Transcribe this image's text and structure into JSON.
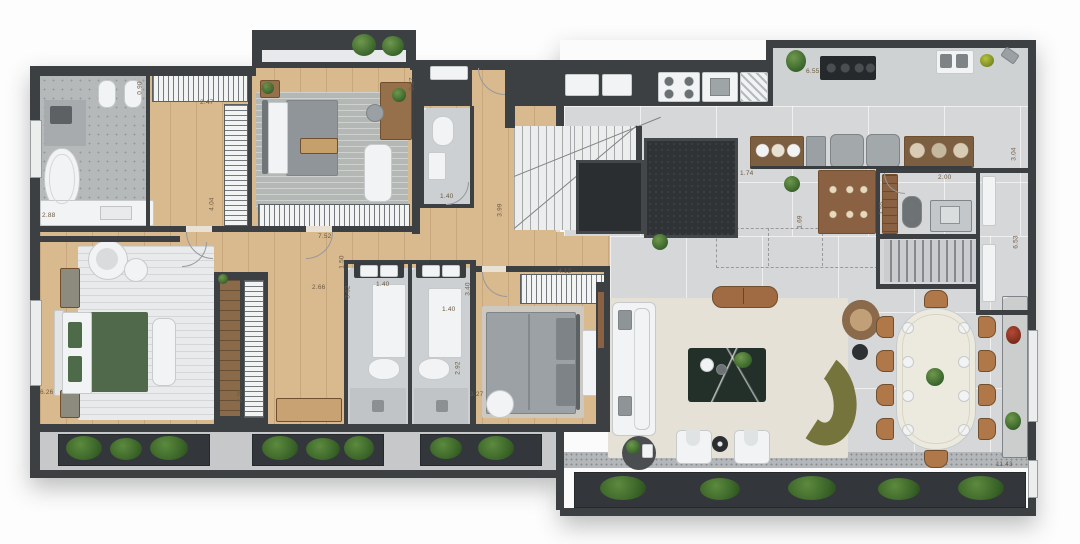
{
  "plan": {
    "labels": [
      {
        "text": "2.88"
      },
      {
        "text": "0.90"
      },
      {
        "text": "2.47"
      },
      {
        "text": "9.75"
      },
      {
        "text": "4.04"
      },
      {
        "text": "3.27"
      },
      {
        "text": "7.52"
      },
      {
        "text": "1.50"
      },
      {
        "text": "2.66"
      },
      {
        "text": "3.62"
      },
      {
        "text": "1.40"
      },
      {
        "text": "3.99"
      },
      {
        "text": "1.40"
      },
      {
        "text": "1.40"
      },
      {
        "text": "3.40"
      },
      {
        "text": "2.92"
      },
      {
        "text": "3.27"
      },
      {
        "text": "4.12"
      },
      {
        "text": "6.55"
      },
      {
        "text": "1.74"
      },
      {
        "text": "2.00"
      },
      {
        "text": "1.69"
      },
      {
        "text": "1.55"
      },
      {
        "text": "3.04"
      },
      {
        "text": "6.53"
      },
      {
        "text": "3.39"
      },
      {
        "text": "6.26"
      },
      {
        "text": "11.43"
      }
    ],
    "palette": {
      "wall": "#3d4043",
      "wood_floor": "#d9b98e",
      "stone_floor": "#b6b9ba",
      "marble_floor": "#ccd0d3",
      "tile_floor": "#d6d7d8",
      "rug_cream": "#e6e1d6",
      "sofa_olive": "#75743c",
      "bed_green": "#50694b",
      "accent_wood": "#96704a",
      "plant_green": "#3f6b2f",
      "planter": "#33363a",
      "label_color": "#6d5b43"
    }
  }
}
